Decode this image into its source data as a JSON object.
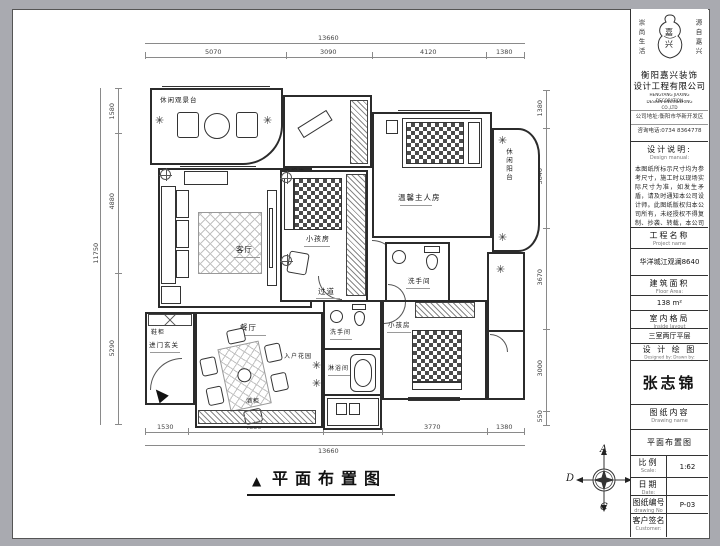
{
  "plan": {
    "caption": "平面布置图",
    "caption_marker": "▲",
    "labels": {
      "balcony_top": "休闲观景台",
      "living": "客厅",
      "tv_wall": "电视墙",
      "kids1": "小孩房",
      "master": "温馨主人房",
      "balcony_right": "休闲阳台",
      "bath_master": "洗手间",
      "corridor": "过道",
      "entry": "进门玄关",
      "shoe_cabinet": "鞋柜",
      "dining": "餐厅",
      "wine_cabinet": "酒柜",
      "entry_garden": "入户花园",
      "bath_guest": "洗手间",
      "shower": "淋浴间",
      "kids2": "小孩房"
    },
    "dims": {
      "top_total": "13660",
      "top": [
        "5070",
        "3090",
        "4120",
        "1380"
      ],
      "bottom": [
        "1530",
        "4850",
        "2130",
        "3770",
        "1380"
      ],
      "bottom_total": "13660",
      "left_total": "11750",
      "left": [
        "1580",
        "4880",
        "5290"
      ],
      "right": [
        "1380",
        "3640",
        "3670",
        "3000",
        "550"
      ]
    },
    "compass": {
      "a": "A",
      "b": "B",
      "c": "C",
      "d": "D"
    }
  },
  "title_block": {
    "slogan_left": "崇尚生活",
    "slogan_right": "源自嘉兴",
    "logo_char_1": "嘉",
    "logo_char_2": "兴",
    "company_cn_1": "衡阳嘉兴装饰",
    "company_cn_2": "设计工程有限公司",
    "company_en_1": "HENGYANG JIAXING DECORATION",
    "company_en_2": "DESIGN ENGINEERING CO.,LTD",
    "address_line": "公司地址:衡阳市华新开发区",
    "phone_line": "咨询电话:0734 8364778",
    "design_note_title": "设计说明:",
    "design_note_title_en": "Design manual:",
    "design_note_body": "本图纸所标示尺寸均为参考尺寸，施工时以现场实际尺寸为准，如发生矛盾，请及时通知本公司设计师。此图纸版权归本公司所有，未经授权不得复制、抄袭、转载，本公司保留最终解释权。",
    "project_name_label": "工程名称",
    "project_name_label_en": "Project name",
    "project_name_value": "华洋城江观澜8640",
    "floor_area_label": "建筑面积",
    "floor_area_label_en": "Floor Area:",
    "floor_area_value": "138 m²",
    "layout_label": "室内格局",
    "layout_label_en": "Inside layout",
    "layout_value": "三室两厅平层",
    "designer_label": "设 计 绘 图",
    "designer_label_en": "Designed by: Drawn by:",
    "designer_name": "张志锦",
    "drawing_label": "图纸内容",
    "drawing_label_en": "Drawing name",
    "drawing_value": "平面布置图",
    "scale_label": "比例",
    "scale_label_en": "Scale:",
    "scale_value": "1:62",
    "date_label": "日期",
    "date_label_en": "Date:",
    "date_value": "",
    "number_label": "图纸编号",
    "number_label_en": "drawing No",
    "number_value": "P-03",
    "customer_label": "客户签名",
    "customer_label_en": "Customer:",
    "customer_value": ""
  }
}
